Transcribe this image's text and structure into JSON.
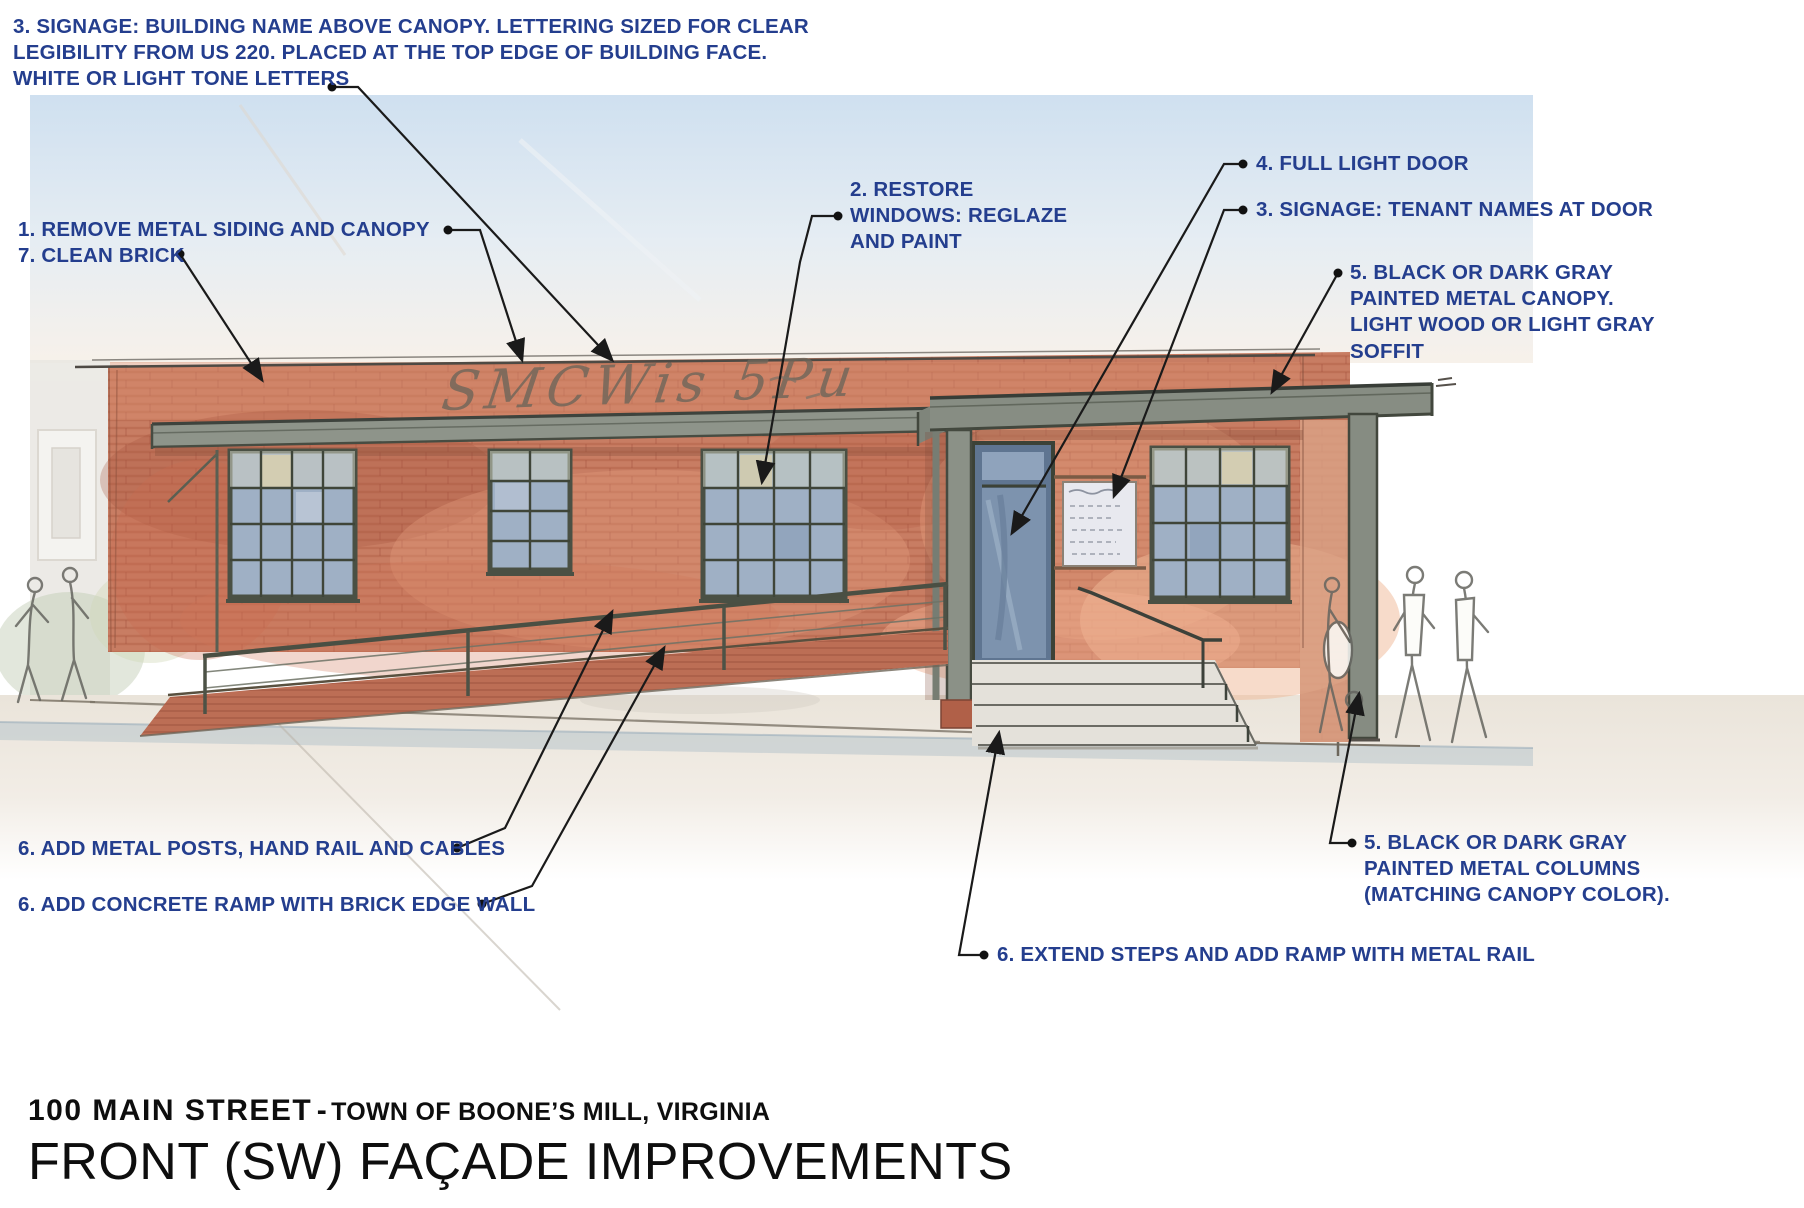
{
  "annotations": {
    "building_signage": "3. SIGNAGE: BUILDING NAME ABOVE CANOPY. LETTERING SIZED FOR CLEAR LEGIBILITY FROM US 220. PLACED AT THE TOP EDGE OF BUILDING FACE. WHITE OR LIGHT TONE LETTERS",
    "remove_siding": "1.  REMOVE METAL SIDING AND CANOPY",
    "clean_brick": "7. CLEAN BRICK",
    "restore_windows": "2. RESTORE WINDOWS: REGLAZE AND PAINT",
    "full_light_door": "4. FULL LIGHT DOOR",
    "tenant_signage": "3. SIGNAGE: TENANT NAMES AT DOOR",
    "canopy": "5. BLACK OR DARK GRAY PAINTED METAL CANOPY. LIGHT WOOD OR LIGHT GRAY SOFFIT",
    "metal_posts": "6. ADD METAL POSTS, HAND RAIL AND CABLES",
    "concrete_ramp": "6. ADD CONCRETE RAMP WITH BRICK EDGE WALL",
    "columns": "5. BLACK OR DARK GRAY PAINTED METAL COLUMNS (MATCHING CANOPY COLOR).",
    "extend_steps": "6. EXTEND STEPS AND ADD RAMP WITH METAL RAIL"
  },
  "drawing": {
    "ghost_sign": "SMCWis 5Pu"
  },
  "title": {
    "address": "100 MAIN STREET",
    "separator": "-",
    "location": "TOWN OF BOONE’S MILL, VIRGINIA",
    "subtitle": "FRONT (SW) FAÇADE IMPROVEMENTS"
  },
  "colors": {
    "annotation_blue": "#243e8e",
    "brick_red": "#c87d63",
    "canopy_gray": "#8b9184",
    "window_glass": "#9fb0c5",
    "sky_blue": "#cfe0f0",
    "leader_black": "#1a1a1a"
  }
}
